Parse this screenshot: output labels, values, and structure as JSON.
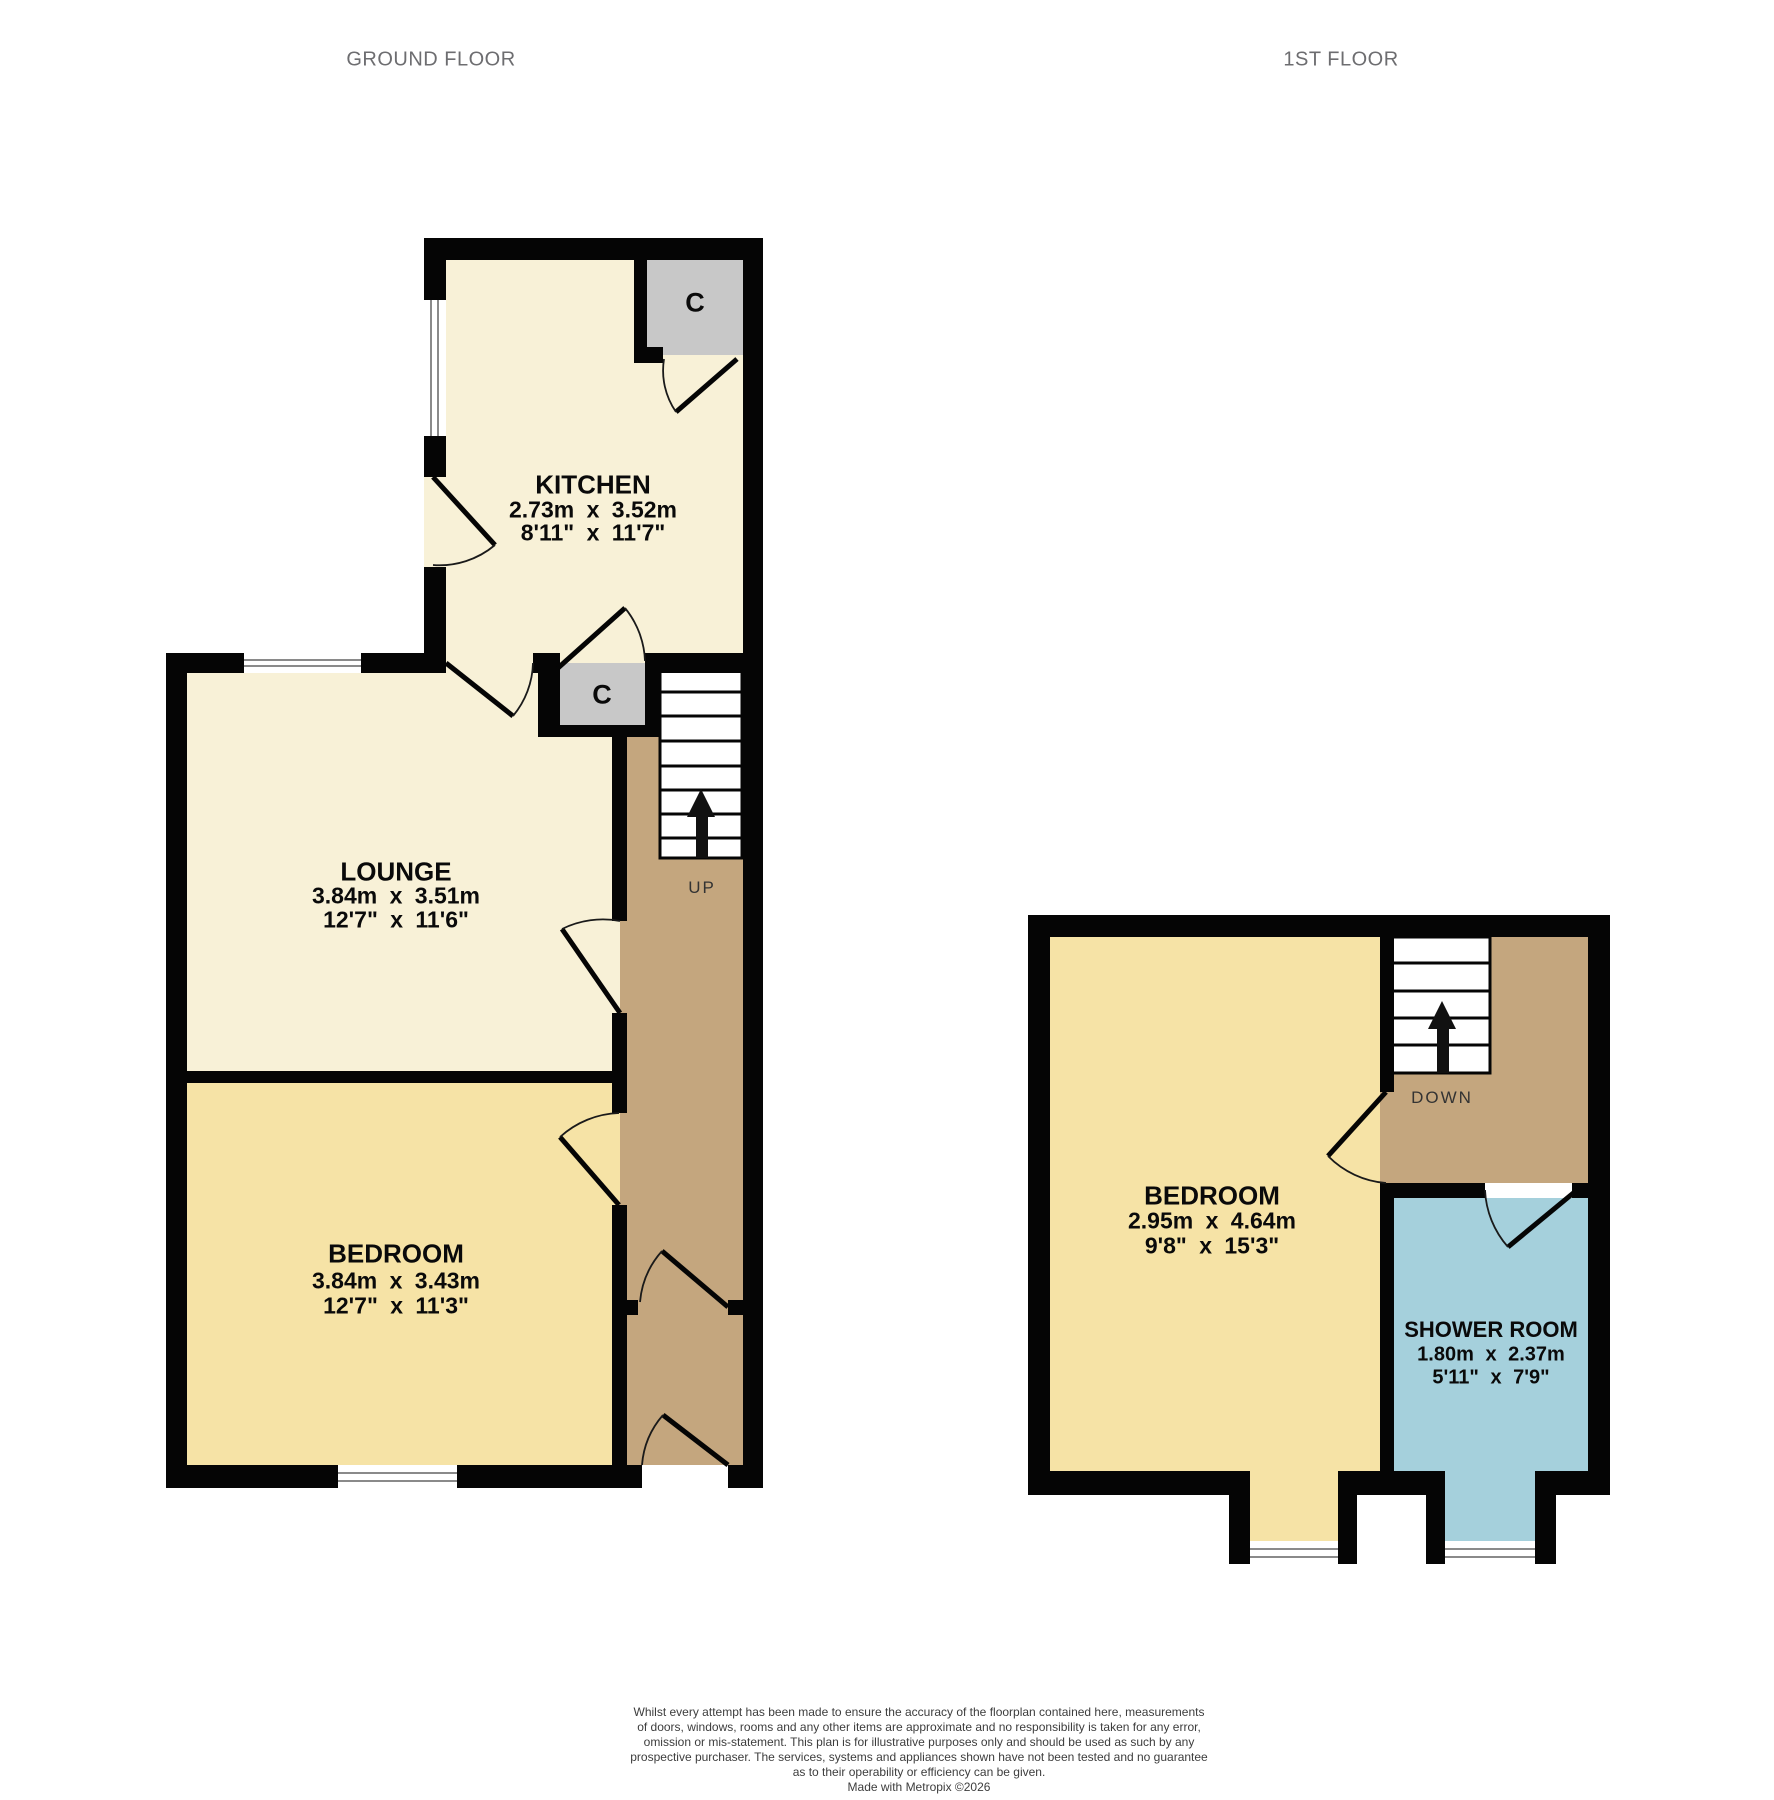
{
  "ground_floor": {
    "title": "GROUND FLOOR",
    "kitchen": {
      "name": "KITCHEN",
      "metric": "2.73m x 3.52m",
      "imperial": "8'11\" x 11'7\""
    },
    "lounge": {
      "name": "LOUNGE",
      "metric": "3.84m x 3.51m",
      "imperial": "12'7\" x 11'6\""
    },
    "bedroom": {
      "name": "BEDROOM",
      "metric": "3.84m x 3.43m",
      "imperial": "12'7\" x 11'3\""
    },
    "closet_top_label": "C",
    "closet_mid_label": "C",
    "stairs_label": "UP"
  },
  "first_floor": {
    "title": "1ST FLOOR",
    "bedroom": {
      "name": "BEDROOM",
      "metric": "2.95m x 4.64m",
      "imperial": "9'8\" x 15'3\""
    },
    "shower_room": {
      "name": "SHOWER ROOM",
      "metric": "1.80m x 2.37m",
      "imperial": "5'11\" x 7'9\""
    },
    "stairs_label": "DOWN"
  },
  "disclaimer": {
    "lines": [
      "Whilst every attempt has been made to ensure the accuracy of the floorplan contained here, measurements",
      "of doors, windows, rooms and any other items are approximate and no responsibility is taken for any error,",
      "omission or mis-statement. This plan is for illustrative purposes only and should be used as such by any",
      "prospective purchaser. The services, systems and appliances shown have not been tested and no guarantee",
      "as to their operability or efficiency can be given.",
      "Made with Metropix ©2026"
    ]
  },
  "colors": {
    "room_cream": "#F8F1D7",
    "room_yellow": "#F6E3A6",
    "hall_tan": "#C4A67E",
    "closet_gray": "#C8C8C8",
    "shower_blue": "#A5D0DC",
    "wall": "#050505"
  }
}
